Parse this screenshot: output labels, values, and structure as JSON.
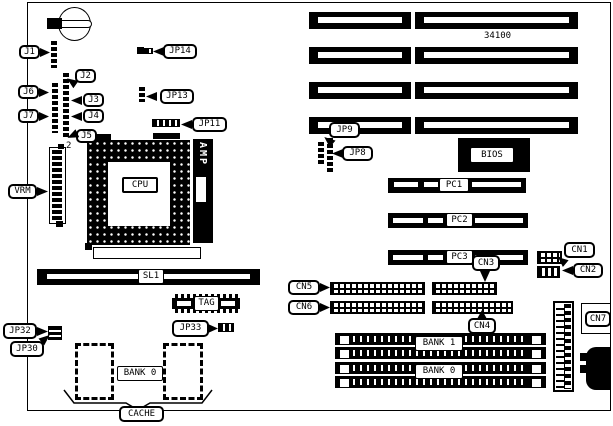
{
  "figure": {
    "part_number": "34100",
    "vrm_pin": "2"
  },
  "callouts": {
    "j1": "J1",
    "j2": "J2",
    "j3": "J3",
    "j4": "J4",
    "j5": "J5",
    "j6": "J6",
    "j7": "J7",
    "jp8": "JP8",
    "jp9": "JP9",
    "jp11": "JP11",
    "jp13": "JP13",
    "jp14": "JP14",
    "jp30": "JP30",
    "jp32": "JP32",
    "jp33": "JP33",
    "vrm": "VRM",
    "cache": "CACHE",
    "cn1": "CN1",
    "cn2": "CN2",
    "cn3": "CN3",
    "cn4": "CN4",
    "cn5": "CN5",
    "cn6": "CN6",
    "cn7": "CN7"
  },
  "components": {
    "cpu": "CPU",
    "amp": "AMP",
    "bios": "BIOS",
    "tag": "TAG",
    "sl1": "SL1",
    "pc1": "PC1",
    "pc2": "PC2",
    "pc3": "PC3",
    "cache_bank": "BANK 0",
    "simm_bank1": "BANK 1",
    "simm_bank0": "BANK 0"
  },
  "colors": {
    "ink": "#000000",
    "paper": "#ffffff"
  }
}
